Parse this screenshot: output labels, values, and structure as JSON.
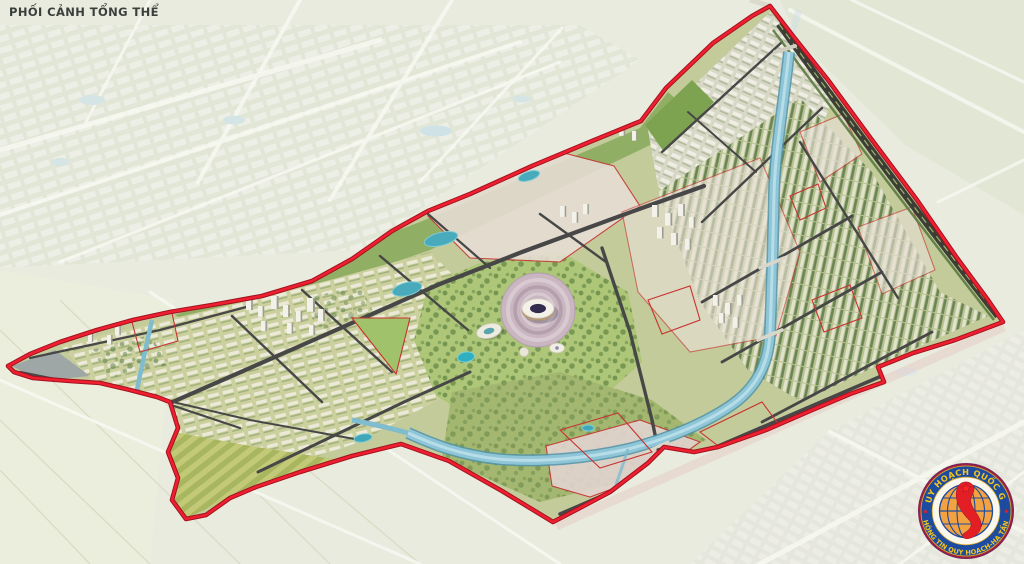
{
  "header": {
    "view_label": "PHỐI CẢNH TỔNG THỂ"
  },
  "map": {
    "type": "urban-masterplan-aerial-perspective",
    "boundary_color": "#ef1f30",
    "subzone_outline_color": "#c83232",
    "river_color": "#8ec6d8",
    "park_color": "#aec677",
    "road_color": "#474747",
    "stadium_plaza_color": "#c9b6c0",
    "faded_context": "outside boundary is desaturated existing city and fields"
  },
  "stamp_logo": {
    "arc_top_text": "QUY HOẠCH QUỐC GIA",
    "arc_bottom_text": "THÔNG TIN QUY HOẠCH-HẠ TẦNG",
    "ring_color": "#1d4ba0",
    "text_color": "#f6c51c",
    "globe_color": "#f2a240",
    "vietnam_map_color": "#e31e24"
  }
}
